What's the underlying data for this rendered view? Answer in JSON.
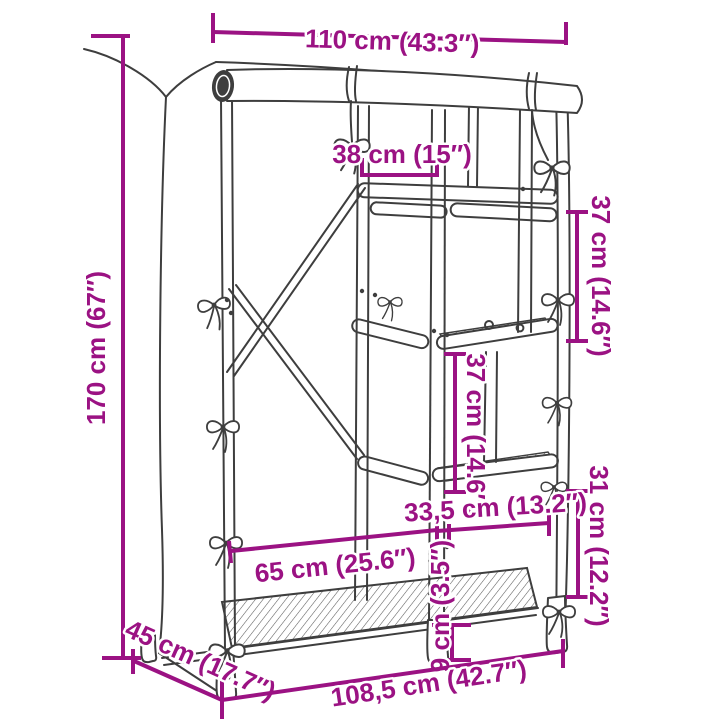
{
  "diagram": {
    "kind": "product-dimension-drawing",
    "subject": "covered wardrobe with shelves",
    "colors": {
      "accent": "#9b1283",
      "line": "#3e3e3e",
      "background": "#ffffff"
    },
    "labels": {
      "width_top": "110 cm (43.3″)",
      "inner_width": "38 cm (15″)",
      "height": "170 cm (67″)",
      "gap_upper_right": "37 cm (14.6″)",
      "gap_middle": "37 cm (14.6″)",
      "gap_lower_right": "31 cm (12.2″)",
      "shelf_right_width": "33,5 cm (13.2″)",
      "shelf_left_width": "65 cm (25.6″)",
      "depth": "45 cm (17.7″)",
      "width_bottom": "108,5 cm (42.7″)",
      "foot_clearance": "9 cm (3.5″)"
    }
  }
}
